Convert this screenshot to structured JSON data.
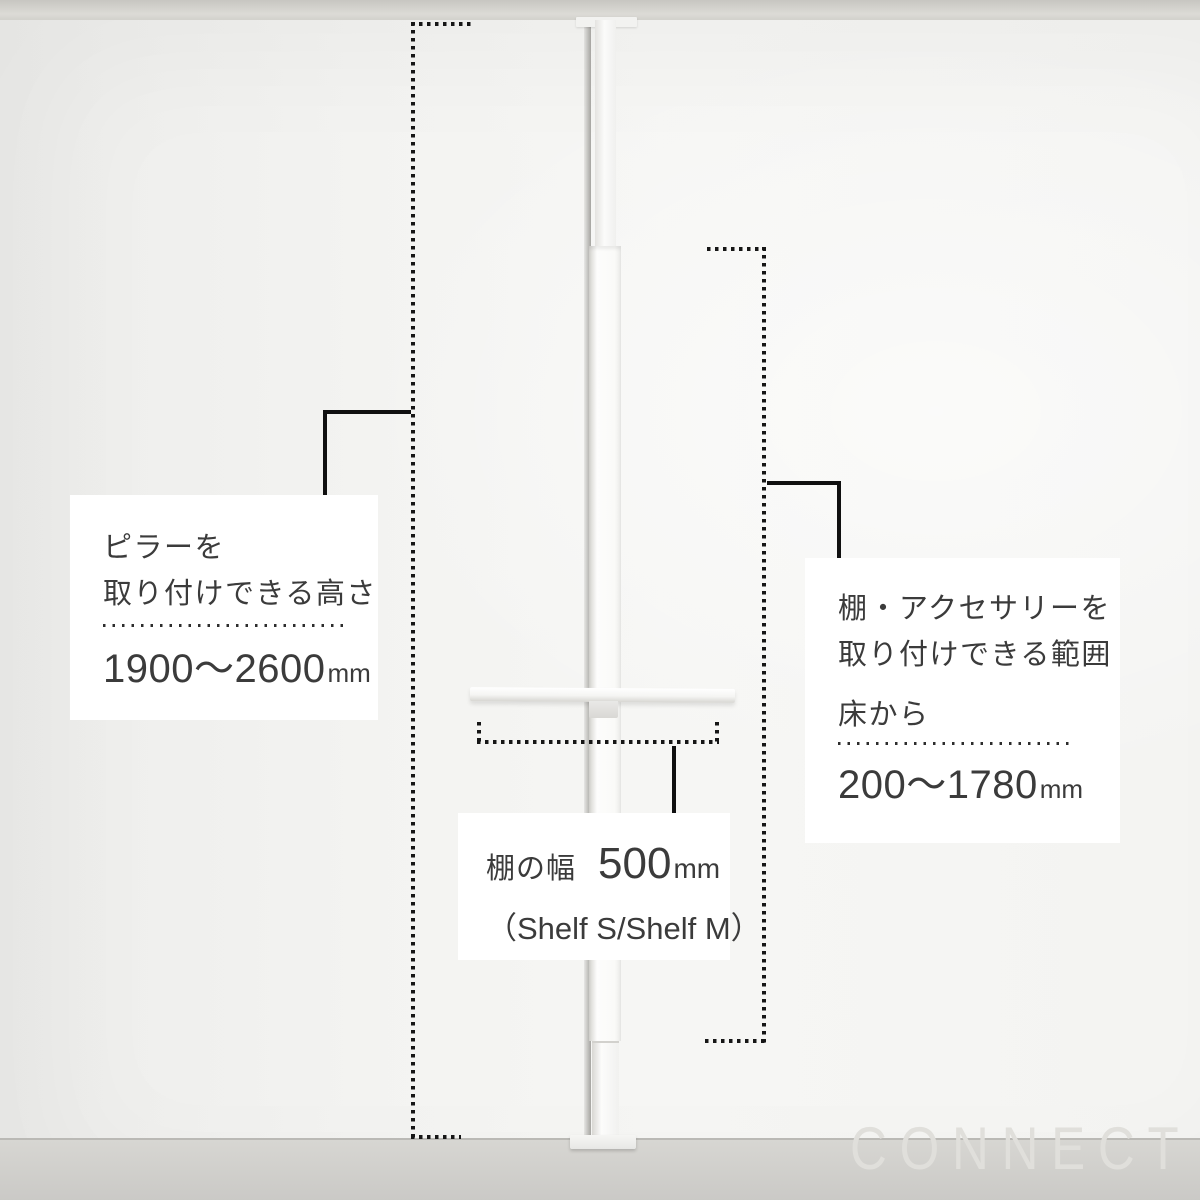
{
  "boxes": {
    "pillar_height": {
      "line1": "ピラーを",
      "line2": "取り付けできる高さ",
      "value": "1900〜2600",
      "unit": "mm"
    },
    "accessory_range": {
      "line1": "棚・アクセサリーを",
      "line2": "取り付けできる範囲",
      "prefix": "床から",
      "value": "200〜1780",
      "unit": "mm"
    },
    "shelf_width": {
      "label": "棚の幅",
      "value": "500",
      "unit": "mm",
      "note": "（Shelf S/Shelf M）"
    }
  },
  "watermark": {
    "text": "CONNECT"
  },
  "colors": {
    "text": "#3b3b3b",
    "annotation_line": "#101010",
    "box_background": "#ffffff",
    "wall": "#f4f4f2",
    "floor": "#cfceca",
    "ceiling": "#d4d3ce",
    "watermark": "#e0dfdb"
  }
}
